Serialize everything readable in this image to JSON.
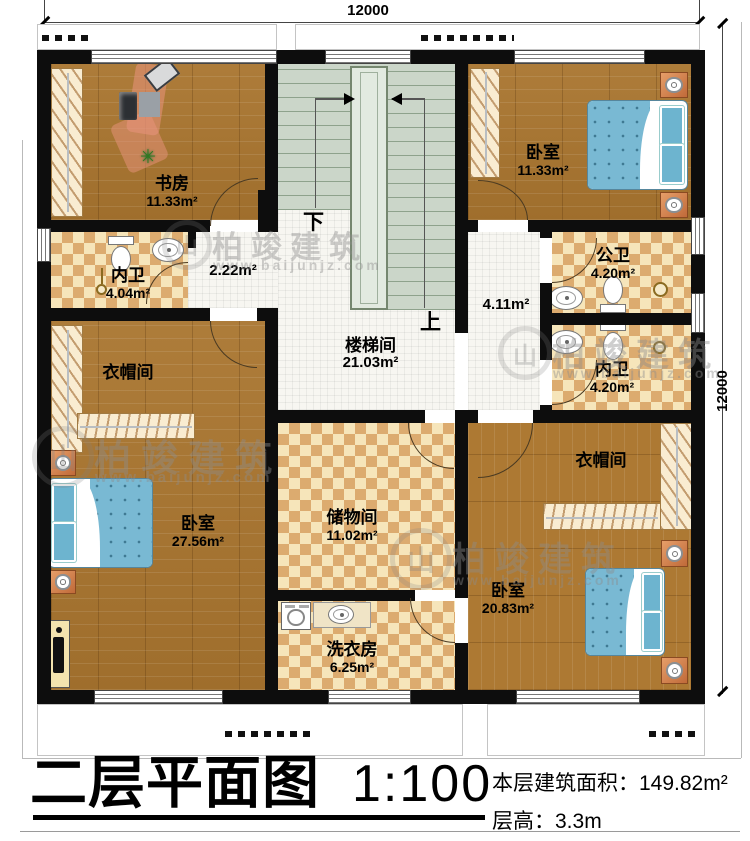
{
  "dimensions": {
    "top": "12000",
    "right": "12000"
  },
  "stair": {
    "down": "下",
    "up": "上"
  },
  "rooms": {
    "study": {
      "name": "书房",
      "area": "11.33m²"
    },
    "bedroom_tr": {
      "name": "卧室",
      "area": "11.33m²"
    },
    "inner_bath_l": {
      "name": "内卫",
      "area": "4.04m²"
    },
    "hall_small": {
      "area": "2.22m²"
    },
    "stairwell": {
      "name": "楼梯间",
      "area": "21.03m²"
    },
    "hall_right": {
      "area": "4.11m²"
    },
    "public_bath": {
      "name": "公卫",
      "area": "4.20m²"
    },
    "inner_bath_r": {
      "name": "内卫",
      "area": "4.20m²"
    },
    "cloak_l": {
      "name": "衣帽间"
    },
    "bedroom_l": {
      "name": "卧室",
      "area": "27.56m²"
    },
    "storage": {
      "name": "储物间",
      "area": "11.02m²"
    },
    "laundry": {
      "name": "洗衣房",
      "area": "6.25m²"
    },
    "cloak_r": {
      "name": "衣帽间"
    },
    "bedroom_br": {
      "name": "卧室",
      "area": "20.83m²"
    }
  },
  "watermark": {
    "brand": "柏竣建筑",
    "url": "www.baijunjz.com",
    "logo_glyph": "山"
  },
  "title": {
    "name": "二层平面图",
    "scale": "1:100",
    "area_label": "本层建筑面积：",
    "area_value": "149.82m²",
    "height_label": "层高：",
    "height_value": "3.3m"
  },
  "colors": {
    "wall": "#0d0d0d",
    "wood": "#a9752f",
    "checker_dark": "#dcab6f",
    "tile": "#f7f6f1",
    "stair_floor": "#cbd6c9",
    "bed_blue": "#79b9d3"
  }
}
